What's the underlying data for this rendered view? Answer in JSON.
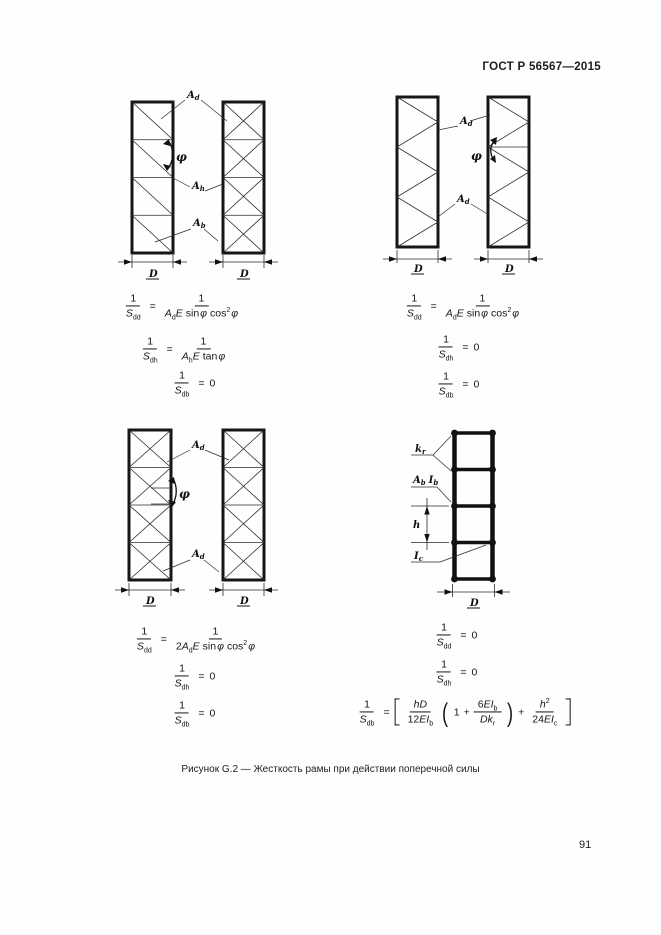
{
  "doc": {
    "header_code": "ГОСТ Р 56567—2015",
    "caption": "Рисунок G.2 — Жесткость рамы при действии поперечной силы",
    "page_number": "91"
  },
  "tok": {
    "one": "1",
    "zero": "0",
    "two": "2",
    "eq": "=",
    "plus": "+",
    "S": "S",
    "sub_dd": "dd",
    "sub_dh": "dh",
    "sub_db": "db",
    "A": "A",
    "E": "E",
    "I": "I",
    "k": "k",
    "h": "h",
    "D": "D",
    "sub_d": "d",
    "sub_h": "h",
    "sub_b": "b",
    "sub_c": "c",
    "sub_r": "r",
    "sin": "sin",
    "cos": "cos",
    "tan": "tan",
    "phi": "φ",
    "sup2": "2",
    "hD": "hD",
    "EI": "EI",
    "Dk": "Dk",
    "n12": "12",
    "n6": "6",
    "n24": "24"
  },
  "diagram_labels": {
    "top_left": [
      "A_d",
      "φ",
      "A_h",
      "A_b",
      "D",
      "D"
    ],
    "top_right": [
      "A_d",
      "φ",
      "A_d",
      "D",
      "D"
    ],
    "bottom_left": [
      "A_d",
      "φ",
      "A_d",
      "D",
      "D"
    ],
    "bottom_right": [
      "k_r",
      "A_b I_b",
      "h",
      "I_c",
      "D"
    ]
  },
  "formulas": {
    "top_left": [
      "1/S_dd = 1/(A_d E sin φ cos² φ)",
      "1/S_dh = 1/(A_h E tan φ)",
      "1/S_db = 0"
    ],
    "top_right": [
      "1/S_dd = 1/(A_d E sin φ cos² φ)",
      "1/S_dh = 0",
      "1/S_db = 0"
    ],
    "bottom_left": [
      "1/S_dd = 1/(2A_d E sin φ cos² φ)",
      "1/S_dh = 0",
      "1/S_db = 0"
    ],
    "bottom_right": [
      "1/S_dd = 0",
      "1/S_dh = 0",
      "1/S_db = [hD/(12EI_b)(1 + 6EI_b/(Dk_r)) + h²/(24EI_c)]"
    ]
  }
}
